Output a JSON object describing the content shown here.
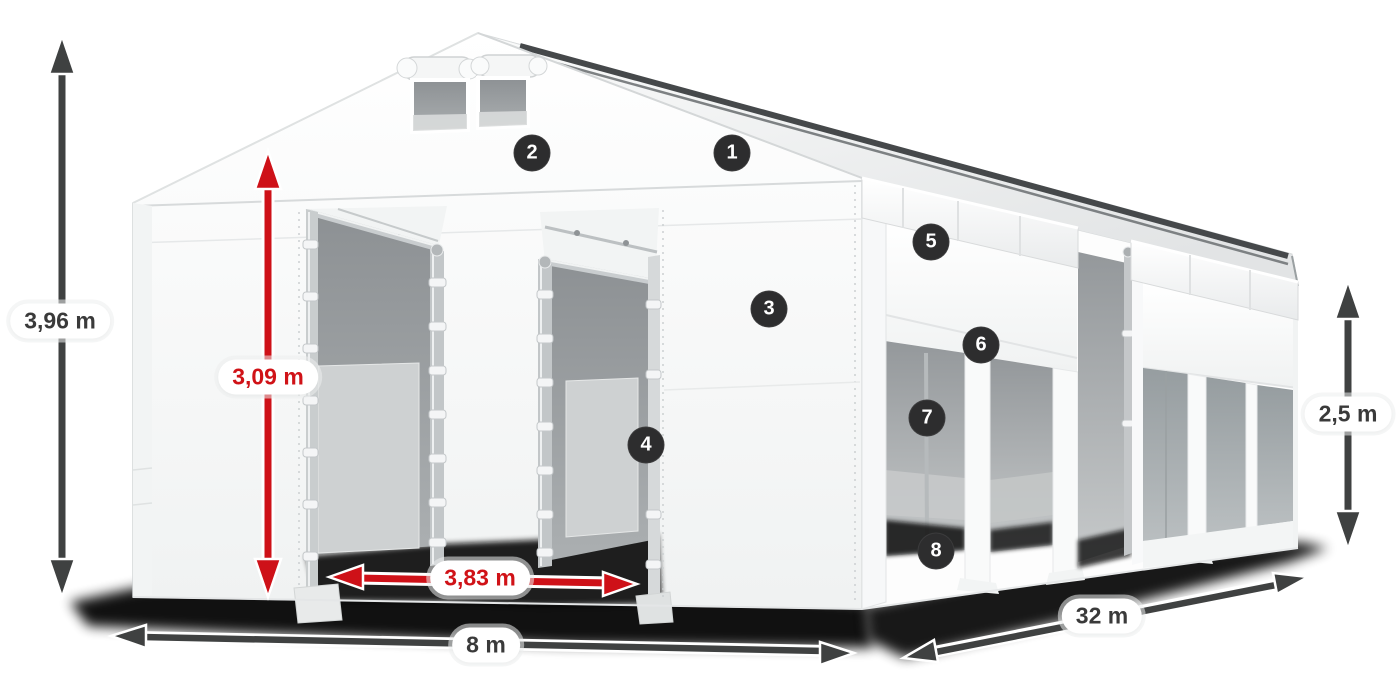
{
  "dimensions": {
    "total_height": {
      "label": "3,96 m",
      "color_key": "dark"
    },
    "door_height": {
      "label": "3,09 m",
      "color_key": "red"
    },
    "door_width": {
      "label": "3,83 m",
      "color_key": "red"
    },
    "front_width": {
      "label": "8 m",
      "color_key": "dark"
    },
    "length": {
      "label": "32 m",
      "color_key": "dark"
    },
    "side_height": {
      "label": "2,5 m",
      "color_key": "dark"
    }
  },
  "hotspots": [
    {
      "number": "1"
    },
    {
      "number": "2"
    },
    {
      "number": "3"
    },
    {
      "number": "4"
    },
    {
      "number": "5"
    },
    {
      "number": "6"
    },
    {
      "number": "7"
    },
    {
      "number": "8"
    }
  ],
  "colors": {
    "accent_red": "#d01217",
    "arrow_dark": "#3f4141",
    "badge_background": "#2d2d2e",
    "badge_number": "#ffffff",
    "label_text": "#3a3a3a",
    "canvas_background": "#ffffff"
  }
}
